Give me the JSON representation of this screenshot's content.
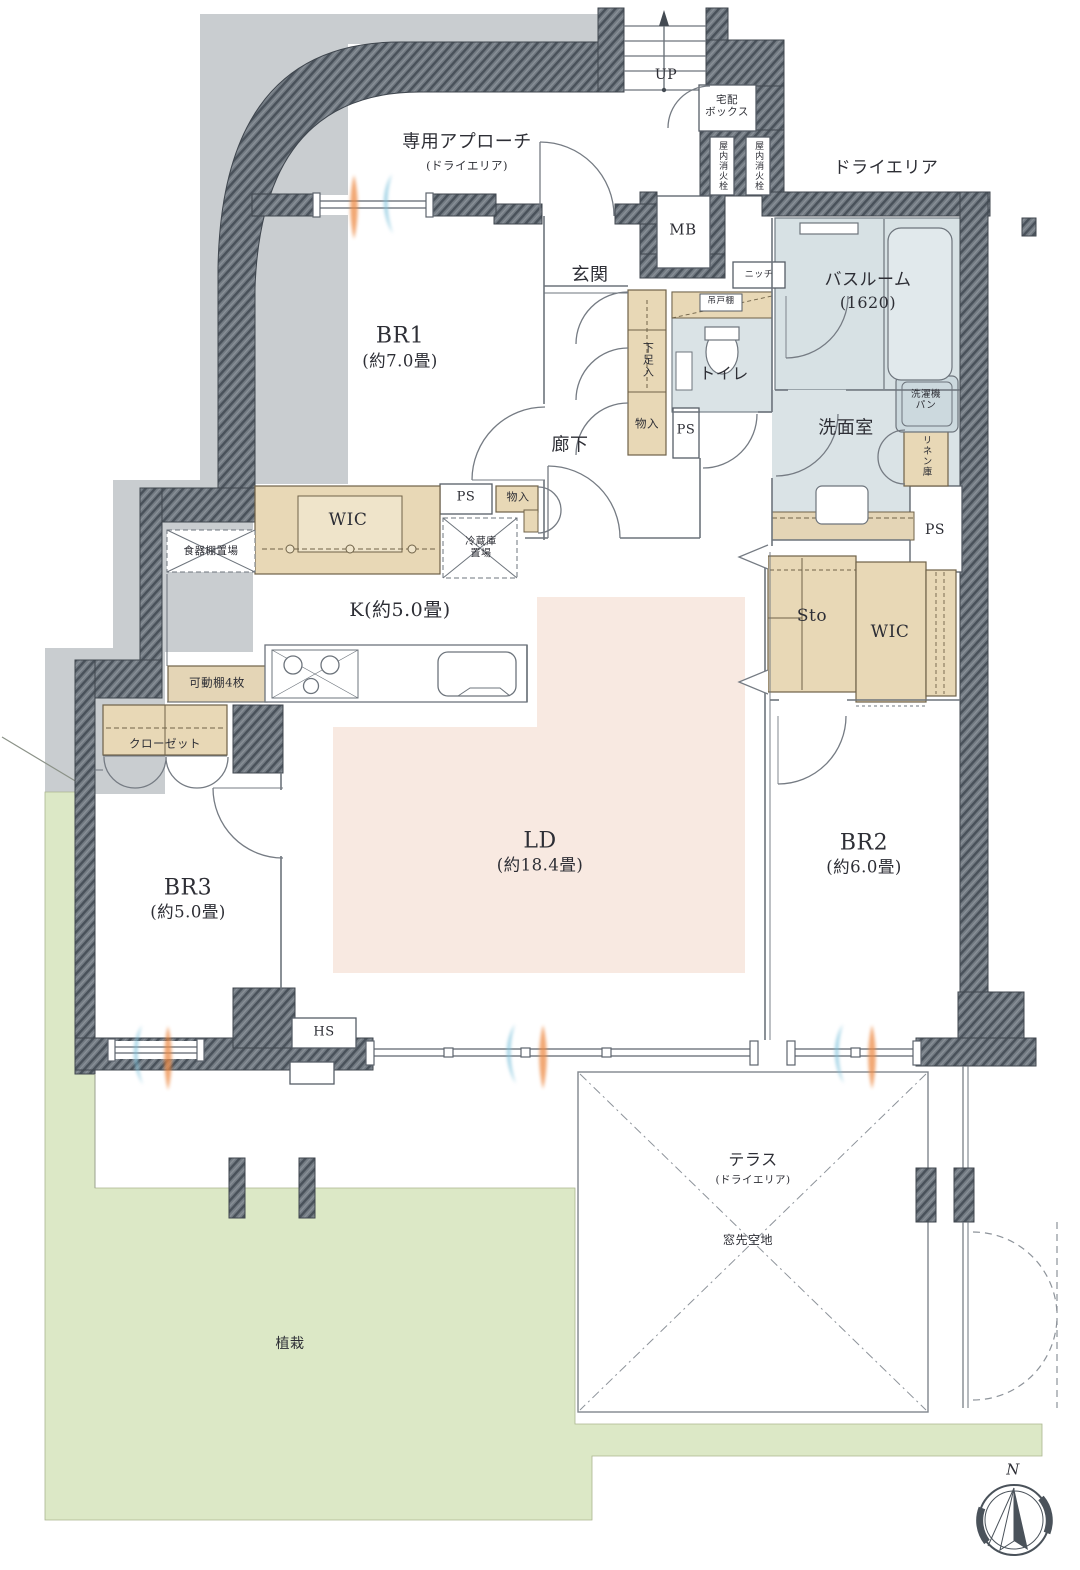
{
  "floor_plan": {
    "entry": {
      "up": "UP",
      "delivery_box": "宅配\nボックス",
      "fire_hydrant": "屋内消火栓",
      "approach": "専用アプローチ",
      "approach_note": "(ドライエリア)",
      "genkan": "玄関",
      "corridor": "廊下",
      "shoe_box": "下足入",
      "storage_small": "物入",
      "niche": "ニッチ",
      "meter_box": "MB",
      "pipe_space": "PS"
    },
    "wet_area": {
      "bathroom": "バスルーム",
      "bathroom_size": "(1620)",
      "toilet": "トイレ",
      "washroom": "洗面室",
      "washer_pan": "洗濯機パン",
      "linen": "リネン庫",
      "hanging_cupboard": "吊戸棚"
    },
    "rooms": {
      "br1": {
        "label": "BR1",
        "size": "(約7.0畳)"
      },
      "br2": {
        "label": "BR2",
        "size": "(約6.0畳)"
      },
      "br3": {
        "label": "BR3",
        "size": "(約5.0畳)"
      },
      "ld": {
        "label": "LD",
        "size": "(約18.4畳)"
      },
      "kitchen": {
        "label": "K(約5.0畳)"
      }
    },
    "storage": {
      "wic": "WIC",
      "sto": "Sto",
      "closet": "クローゼット",
      "movable_shelf": "可動棚4枚",
      "dish_shelf": "食器棚置場",
      "fridge_space": "冷蔵庫置場",
      "hs": "HS"
    },
    "outdoor": {
      "dry_area": "ドライエリア",
      "terrace": "テラス",
      "terrace_note": "(ドライエリア)",
      "window_open_space": "窓先空地",
      "planting": "植栽"
    },
    "compass": {
      "north": "N"
    }
  }
}
